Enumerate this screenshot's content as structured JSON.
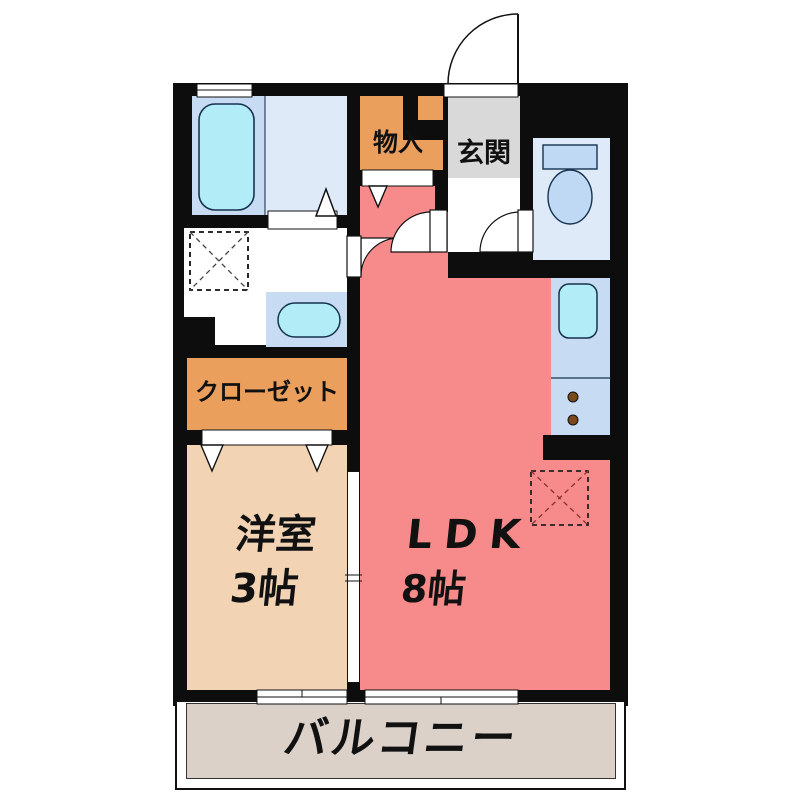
{
  "plan_type": "apartment-floor-plan",
  "rooms": {
    "storage": {
      "label": "物入"
    },
    "entrance": {
      "label": "玄関"
    },
    "closet": {
      "label": "クローゼット"
    },
    "western_room": {
      "label": "洋室",
      "size": "3帖"
    },
    "ldk": {
      "label": "LDK",
      "size": "8帖"
    },
    "balcony": {
      "label": "バルコニー"
    }
  },
  "fixtures": {
    "bathtub": "bathtub",
    "washbasin": "washbasin",
    "washer_space": "washing-machine-space",
    "toilet": "toilet",
    "kitchen_sink": "kitchen-sink",
    "stove": "two-burner-stove",
    "fridge_space": "refrigerator-space"
  },
  "colors": {
    "wall": "#0d0d0d",
    "ldk": "#f78a8a",
    "western_room": "#f2d4b5",
    "closet_orange": "#eb9f5d",
    "entrance_gray": "#d9d9d9",
    "water_room_light": "#dfeaf9",
    "counter_blue": "#c7dcf3",
    "fixture_cyan": "#b2ecf6",
    "toilet_blue": "#bfd8f3",
    "balcony_beige": "#dcd1c9",
    "burner_brown": "#7a4a1c"
  }
}
